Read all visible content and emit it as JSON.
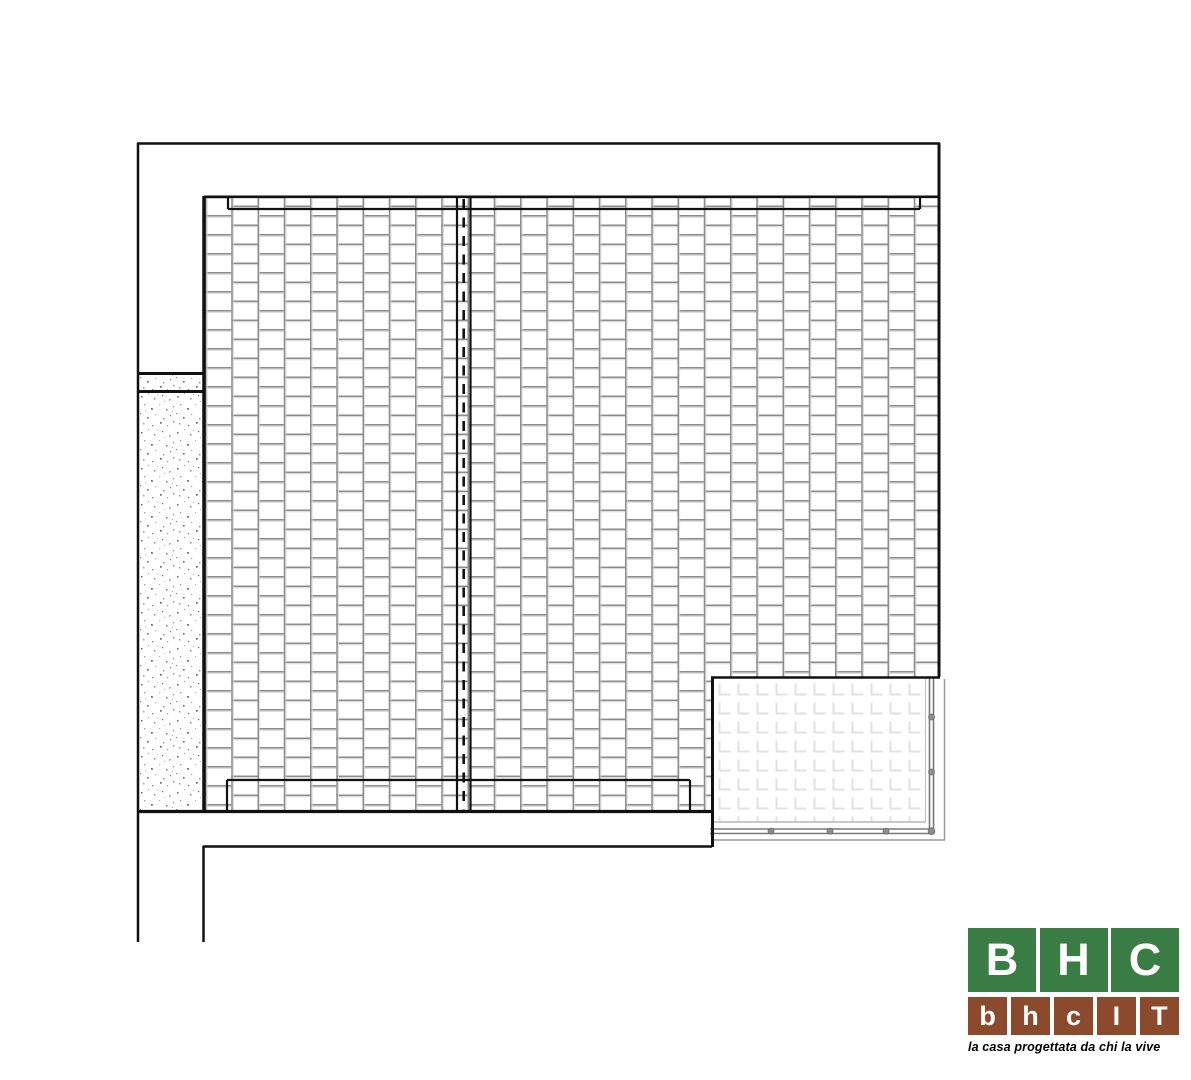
{
  "logo": {
    "green_letters": [
      "B",
      "H",
      "C"
    ],
    "brown_letters": [
      "b",
      "h",
      "c",
      "I",
      "T"
    ],
    "tagline": "la casa progettata da chi la vive"
  },
  "colors": {
    "logo_green": "#3A7D44",
    "logo_brown": "#8B4A2B",
    "line_black": "#111111",
    "hatch_gray": "#8c8c8c",
    "panel_gray": "#e1e1e1"
  }
}
